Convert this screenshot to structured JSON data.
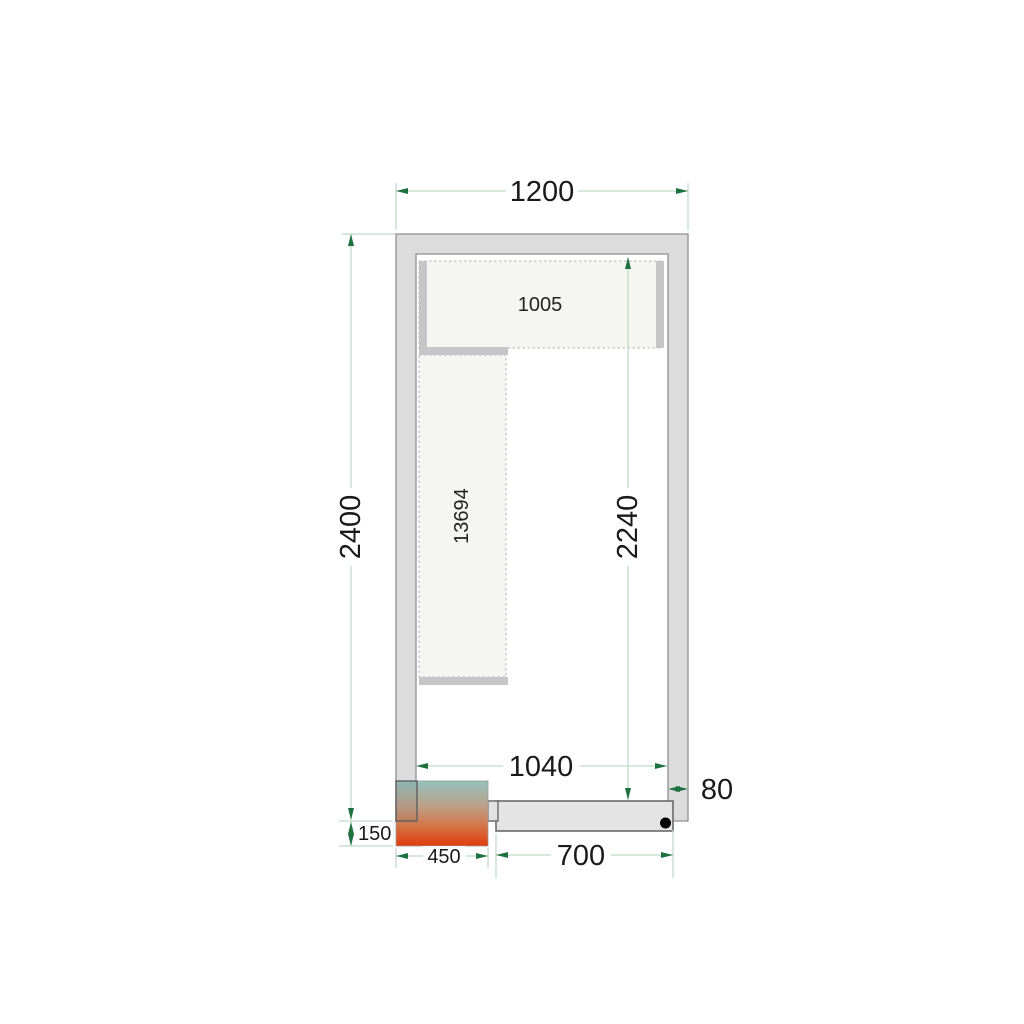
{
  "drawing": {
    "description": "Cold room floor plan with shelving, door and condensing unit",
    "dimensions": {
      "outer_width": "1200",
      "outer_height": "2400",
      "interior_width": "1040",
      "interior_height": "2240",
      "wall_thickness": "80",
      "door_width": "700",
      "unit_width": "450",
      "unit_protrusion": "150"
    },
    "shelf_labels": {
      "top_shelf": "1005",
      "left_shelf": "13694"
    },
    "colors": {
      "background": "#ffffff",
      "dimension_line": "#bfd9c8",
      "dimension_arrow": "#1d7140",
      "label_color": "#1a1a1a",
      "wall_fill": "#dcdcdc",
      "wall_edge": "#8f8f8f",
      "shelf_fill": "#f5f5f2",
      "shelf_border": "#c2c2c2",
      "shelf_bar": "#c6c6c6",
      "door_fill": "#e4e4e4",
      "door_edge": "#6a6a6a",
      "door_stub_fill": "#e2e2e2",
      "hinge_dot": "#000000",
      "unit_gradient": [
        "#93c2bc",
        "#bda089",
        "#d4764a",
        "#e23c0c"
      ]
    }
  }
}
